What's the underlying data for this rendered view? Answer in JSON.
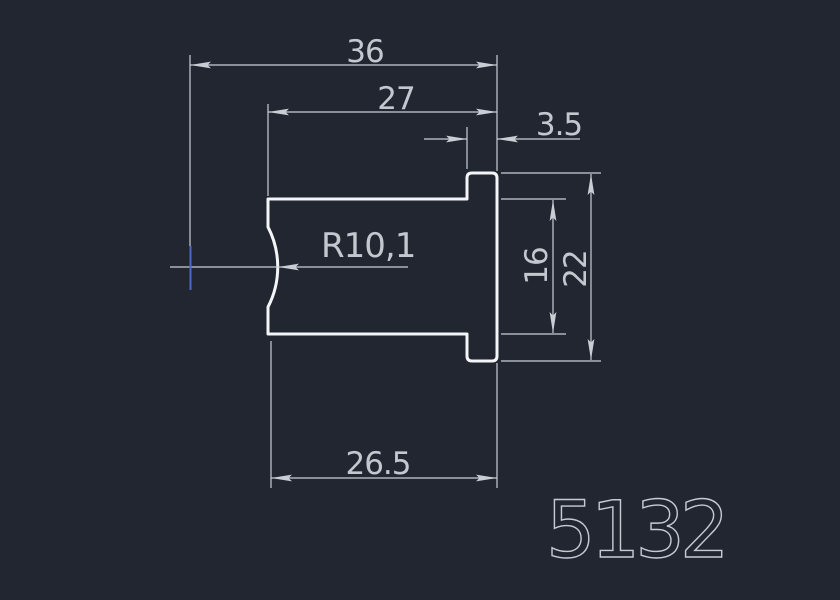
{
  "drawing": {
    "type": "2d-cad-profile",
    "part_number": "5132",
    "dimensions": {
      "total_width": "36",
      "body_width": "27",
      "flange_width": "3.5",
      "radius": "R10,1",
      "body_height": "16",
      "flange_height": "22",
      "bottom_width": "26.5"
    },
    "colors": {
      "background": "#212630",
      "outline": "#f4f5f7",
      "dimension_lines": "#c9ced5",
      "dimension_text": "#c3c8cf",
      "part_number_text": "#c6cbd2",
      "center_mark": "#4c69c5"
    }
  }
}
